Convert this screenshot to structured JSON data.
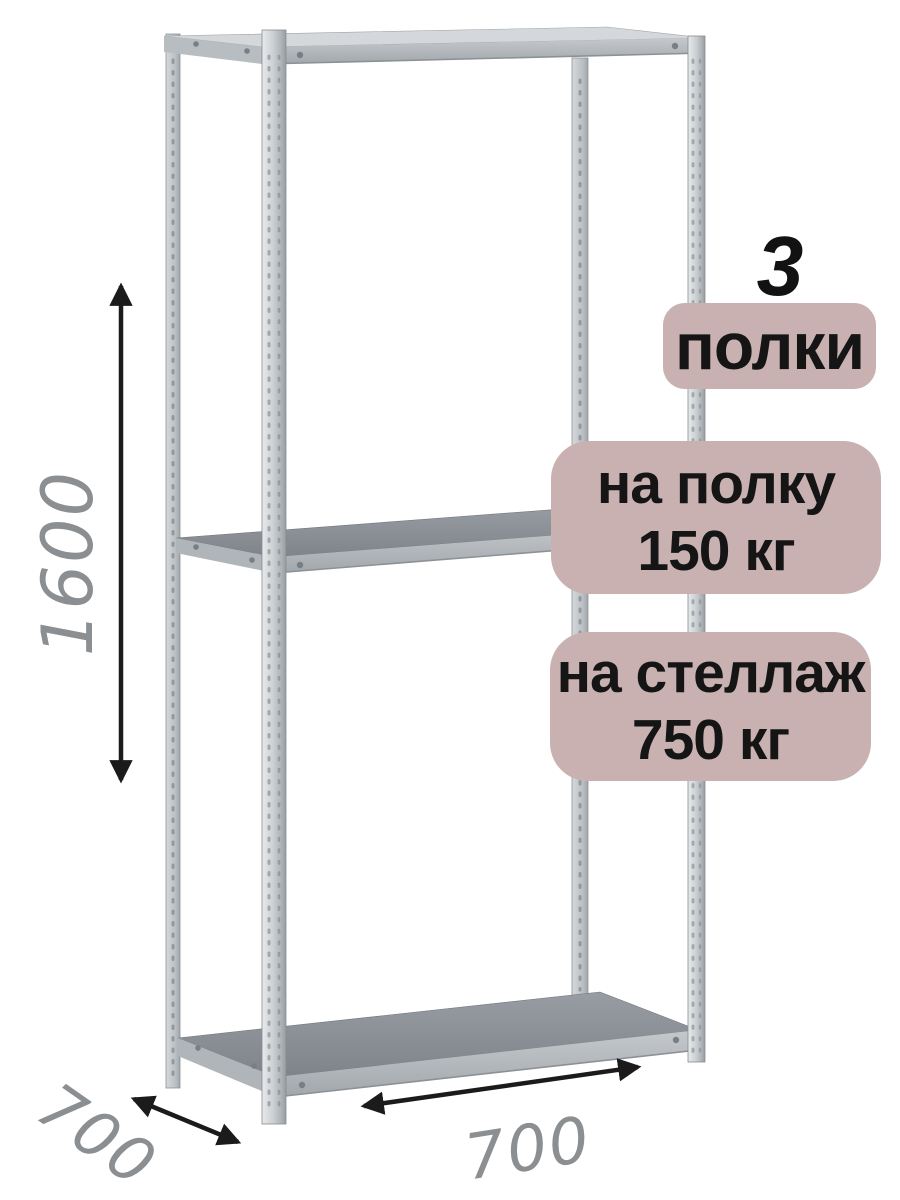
{
  "illustration": {
    "subject": "metal boltless shelving rack, isometric product render",
    "shelves_visible": 3
  },
  "dimensions": {
    "height_mm": "1600",
    "depth_mm": "700",
    "width_mm": "700"
  },
  "badges": {
    "shelf_count": "3",
    "shelf_count_label": "полки",
    "per_shelf": {
      "line1": "на полку",
      "line2": "150 кг"
    },
    "total": {
      "line1": "на стеллаж",
      "line2": "750 кг"
    }
  },
  "colors": {
    "badge_background": "#c8b1b0",
    "badge_text": "#151515",
    "dimension_text": "#8b8f91",
    "arrow": "#1b1b1b",
    "metal_light": "#d4d8db",
    "metal_mid": "#aeb3b7",
    "shelf_surface": "#84898e"
  }
}
